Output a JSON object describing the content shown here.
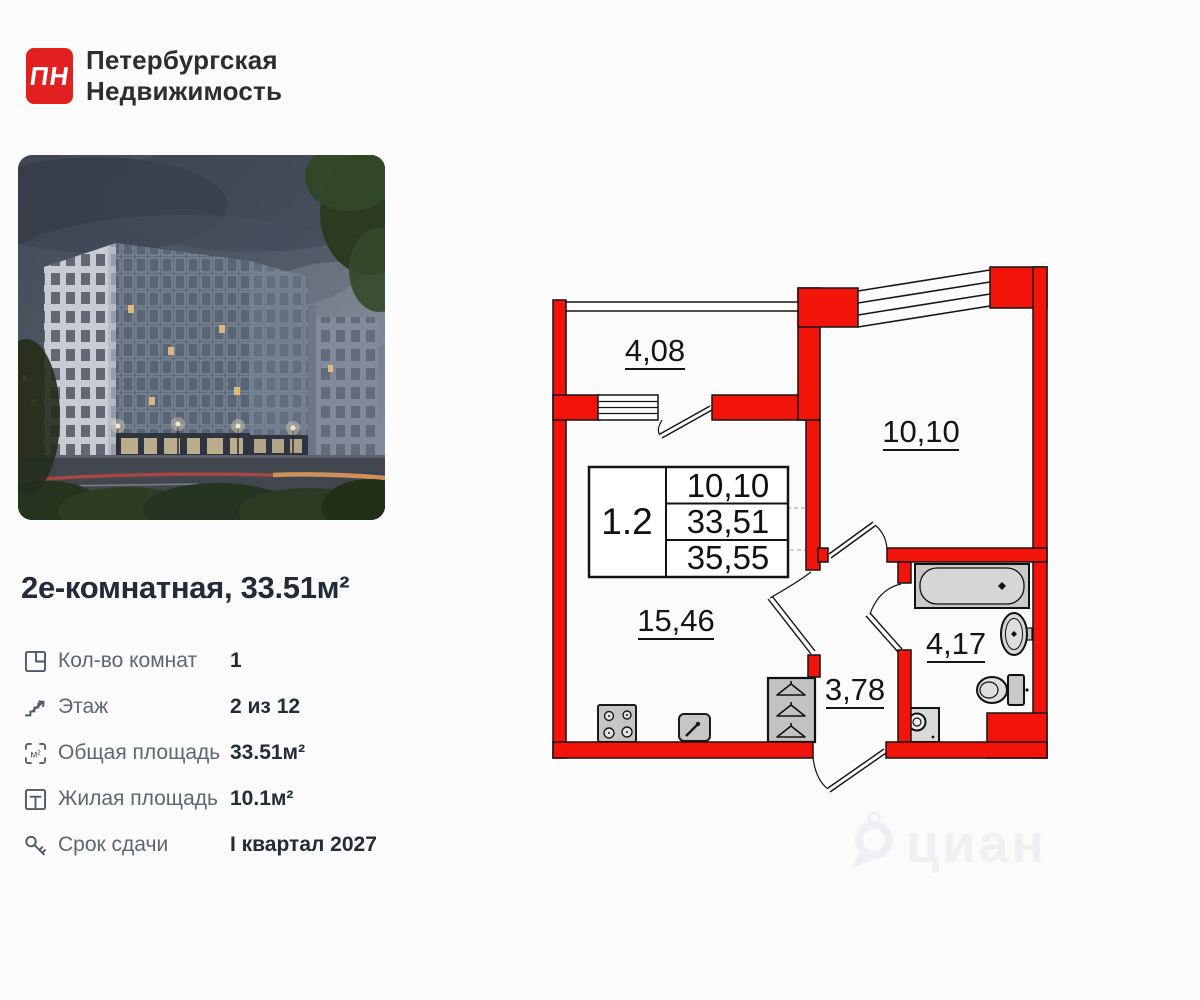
{
  "brand": {
    "logo_letters": "ПН",
    "logo_color": "#e32020",
    "name_line1": "Петербургская",
    "name_line2": "Недвижимость"
  },
  "listing": {
    "title": "2е-комнатная, 33.51м²"
  },
  "details": {
    "rows": [
      {
        "label": "Кол-во комнат",
        "value": "1"
      },
      {
        "label": "Этаж",
        "value": "2 из 12"
      },
      {
        "label": "Общая площадь",
        "value": "33.51м²"
      },
      {
        "label": "Жилая площадь",
        "value": "10.1м²"
      },
      {
        "label": "Срок сдачи",
        "value": "I квартал 2027"
      }
    ],
    "area_icon_glyph": "м²"
  },
  "floorplan": {
    "wall_color": "#f2140b",
    "unit_table": {
      "unit": "1.2",
      "row1": "10,10",
      "row2": "33,51",
      "row3": "35,55"
    },
    "labels": {
      "loggia": "4,08",
      "bedroom": "10,10",
      "kitchen_living": "15,46",
      "hallway": "3,78",
      "bathroom": "4,17"
    }
  },
  "watermark": {
    "text": "циан"
  }
}
